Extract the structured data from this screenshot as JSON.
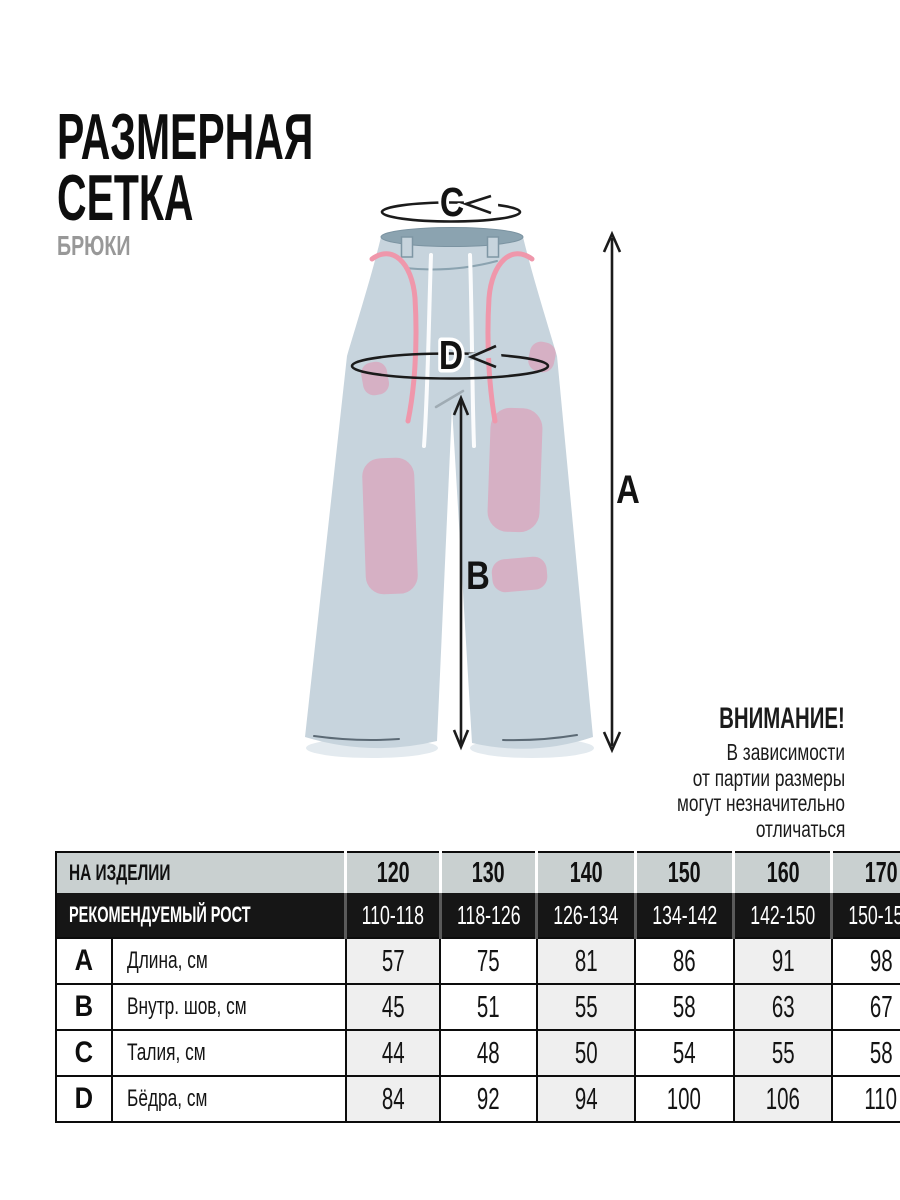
{
  "header": {
    "title_line1": "РАЗМЕРНАЯ",
    "title_line2": "СЕТКА",
    "subtitle": "БРЮКИ"
  },
  "diagram": {
    "labels": {
      "a": "A",
      "b": "B",
      "c": "C",
      "d": "D"
    },
    "colors": {
      "pants": "#c7d4dd",
      "patch": "#d6b0c4",
      "waist_opening": "#8ba3b0",
      "drawstring_pink": "#ef97ab",
      "drawstring_white": "#fbfcfd",
      "arrow": "#1b1b1b",
      "shadow": "#e3eaef"
    }
  },
  "notice": {
    "title": "ВНИМАНИЕ!",
    "lines": [
      "В зависимости",
      "от партии размеры",
      "могут незначительно",
      "отличаться"
    ]
  },
  "table": {
    "header_row1_label": "НА ИЗДЕЛИИ",
    "sizes": [
      "120",
      "130",
      "140",
      "150",
      "160",
      "170"
    ],
    "header_row2_label": "РЕКОМЕНДУЕМЫЙ РОСТ",
    "heights": [
      "110-118",
      "118-126",
      "126-134",
      "134-142",
      "142-150",
      "150-158"
    ],
    "rows": [
      {
        "key": "A",
        "label": "Длина, см",
        "values": [
          "57",
          "75",
          "81",
          "86",
          "91",
          "98"
        ]
      },
      {
        "key": "B",
        "label": "Внутр. шов, см",
        "values": [
          "45",
          "51",
          "55",
          "58",
          "63",
          "67"
        ]
      },
      {
        "key": "C",
        "label": "Талия, см",
        "values": [
          "44",
          "48",
          "50",
          "54",
          "55",
          "58"
        ]
      },
      {
        "key": "D",
        "label": "Бёдра, см",
        "values": [
          "84",
          "92",
          "94",
          "100",
          "106",
          "110"
        ]
      }
    ],
    "colors": {
      "header1_bg": "#c9d0d0",
      "header2_bg": "#161616",
      "alt_column_bg": "#efefef"
    }
  }
}
